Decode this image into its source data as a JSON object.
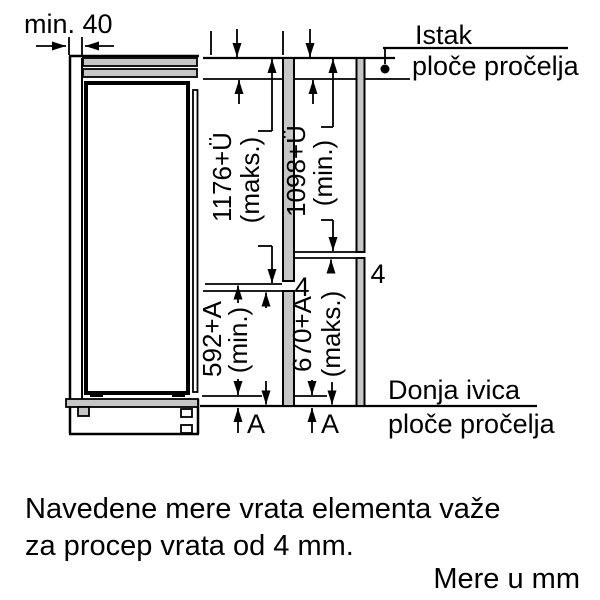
{
  "diagram": {
    "min_clearance": "min. 40",
    "istak": {
      "line1": "Istak",
      "line2": "ploče pročelja"
    },
    "donja": {
      "line1": "Donja ivica",
      "line2": "ploče pročelja"
    },
    "dims": {
      "upper_left": {
        "value": "1176+Ü",
        "qual": "(maks.)"
      },
      "upper_right": {
        "value": "1098+Ü",
        "qual": "(min.)"
      },
      "lower_left": {
        "value": "592+A",
        "qual": "(min.)"
      },
      "lower_right": {
        "value": "670+A",
        "qual": "(maks.)"
      }
    },
    "gaps": {
      "left": "4",
      "right": "4"
    },
    "a_labels": {
      "left": "A",
      "right": "A"
    }
  },
  "notes": {
    "line1": "Navedene mere vrata elementa važe",
    "line2": "za procep vrata od 4 mm.",
    "units": "Mere u mm"
  },
  "colors": {
    "line": "#000000",
    "panel": "#c6c6c6",
    "background": "#ffffff"
  }
}
